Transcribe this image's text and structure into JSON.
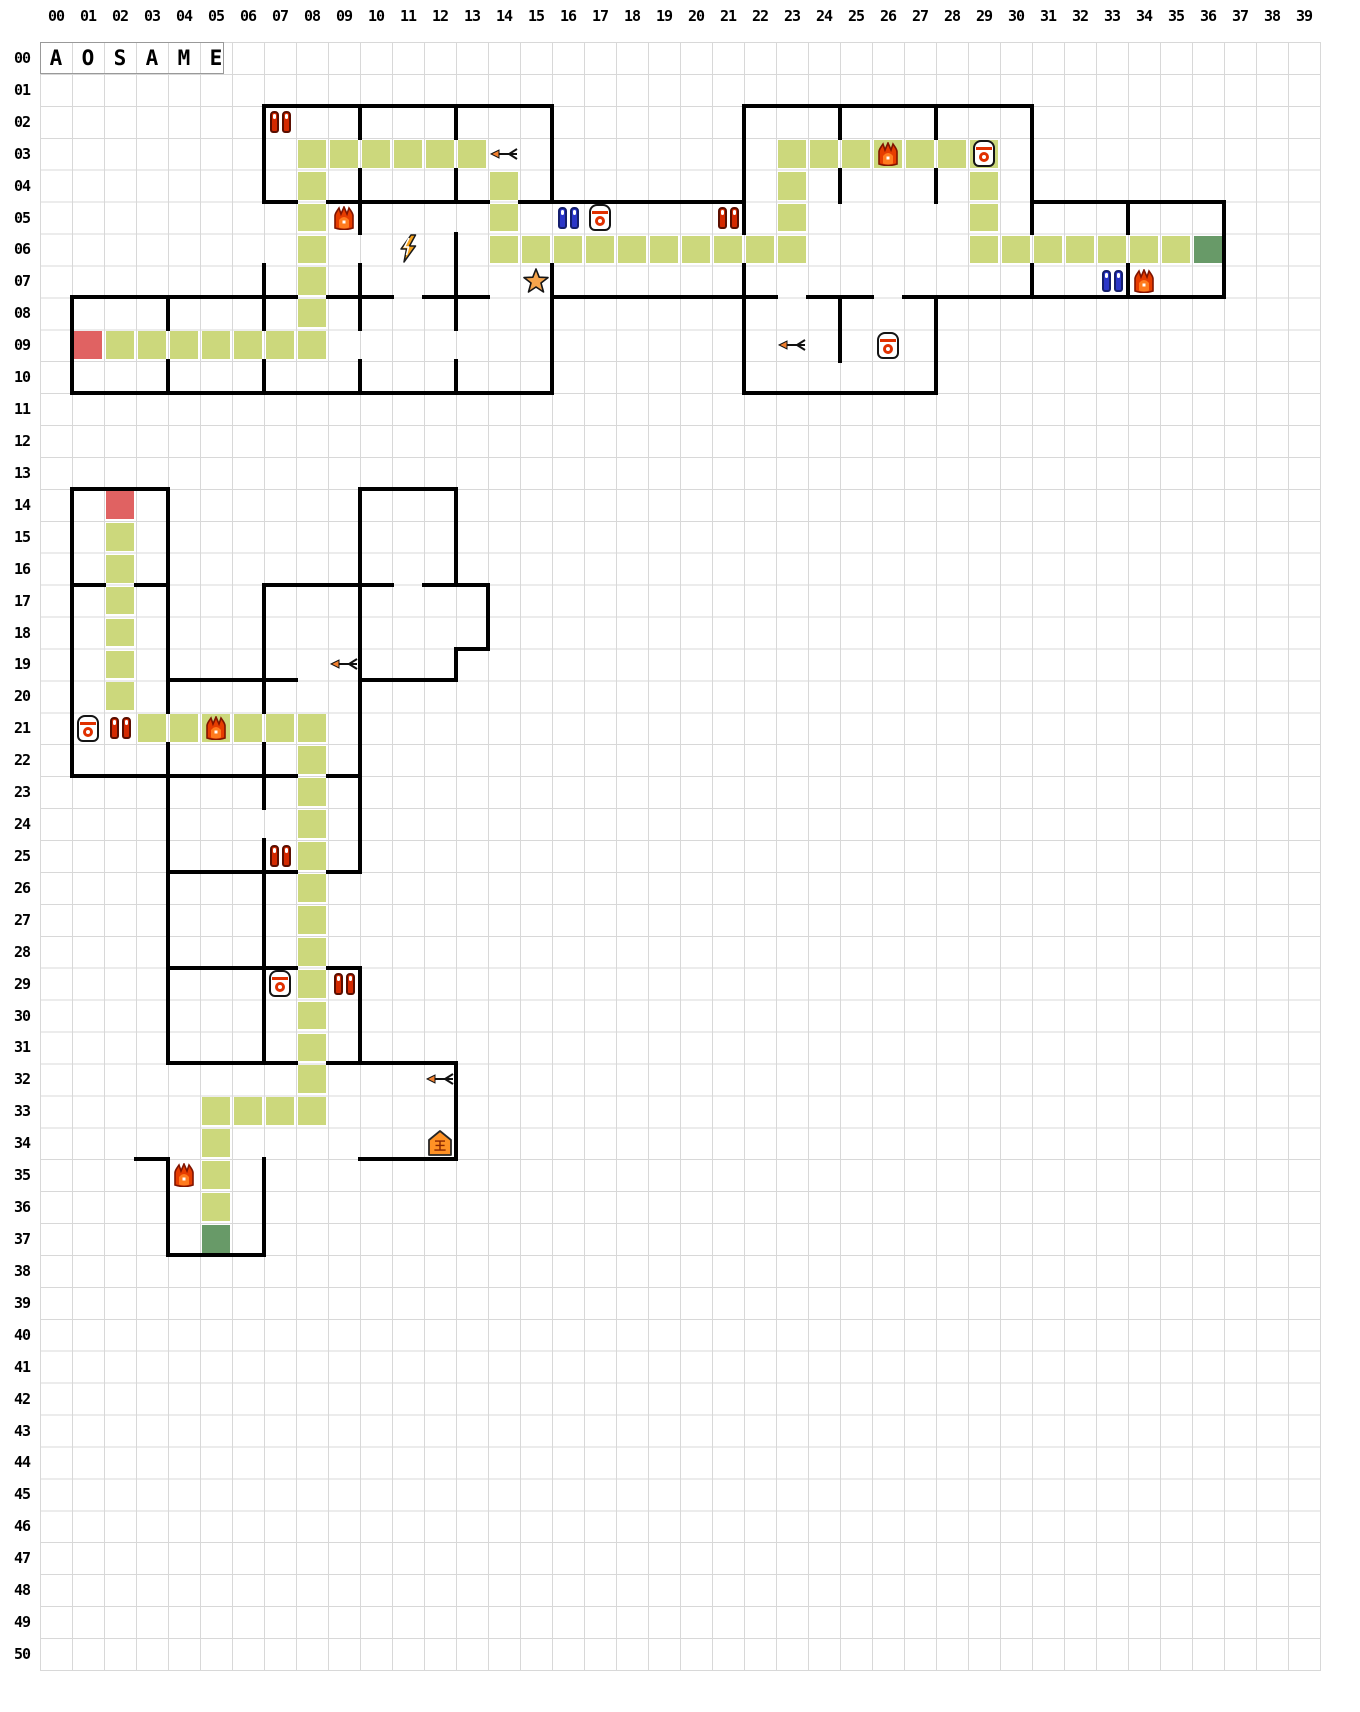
{
  "app": {
    "name_plate": [
      "A",
      "O",
      "S",
      "A",
      "M",
      "E"
    ]
  },
  "grid": {
    "cols": 40,
    "rows": 51,
    "col_labels": [
      "00",
      "01",
      "02",
      "03",
      "04",
      "05",
      "06",
      "07",
      "08",
      "09",
      "10",
      "11",
      "12",
      "13",
      "14",
      "15",
      "16",
      "17",
      "18",
      "19",
      "20",
      "21",
      "22",
      "23",
      "24",
      "25",
      "26",
      "27",
      "28",
      "29",
      "30",
      "31",
      "32",
      "33",
      "34",
      "35",
      "36",
      "37",
      "38",
      "39"
    ],
    "row_labels": [
      "00",
      "01",
      "02",
      "03",
      "04",
      "05",
      "06",
      "07",
      "08",
      "09",
      "10",
      "11",
      "12",
      "13",
      "14",
      "15",
      "16",
      "17",
      "18",
      "19",
      "20",
      "21",
      "22",
      "23",
      "24",
      "25",
      "26",
      "27",
      "28",
      "29",
      "30",
      "31",
      "32",
      "33",
      "34",
      "35",
      "36",
      "37",
      "38",
      "39",
      "40",
      "41",
      "42",
      "43",
      "44",
      "45",
      "46",
      "47",
      "48",
      "49",
      "50"
    ]
  },
  "colors": {
    "background": "#ffffff",
    "grid_line": "#d8d8d8",
    "wall": "#000000",
    "path": "#ccd87c",
    "start": "#e06262",
    "goal": "#689a68",
    "label": "#000000",
    "flame": "#e63d00",
    "flame_inner": "#ff7b1e",
    "capsule_red": "#d42900",
    "capsule_blue": "#2b36c8",
    "bell_accent": "#e03000",
    "lightning": "#f7a21b",
    "star": "#f5a44c",
    "arrow_head": "#f08030",
    "house": "#ff9225"
  },
  "house_glyph": "王",
  "map": {
    "walls_h": [
      [
        2,
        7,
        15
      ],
      [
        2,
        22,
        30
      ],
      [
        5,
        7,
        7
      ],
      [
        5,
        9,
        13
      ],
      [
        5,
        15,
        21
      ],
      [
        5,
        31,
        36
      ],
      [
        8,
        1,
        7
      ],
      [
        8,
        9,
        10
      ],
      [
        8,
        12,
        13
      ],
      [
        8,
        16,
        22
      ],
      [
        8,
        24,
        25
      ],
      [
        8,
        27,
        36
      ],
      [
        11,
        1,
        15
      ],
      [
        11,
        22,
        27
      ],
      [
        14,
        1,
        3
      ],
      [
        14,
        10,
        12
      ],
      [
        17,
        1,
        1
      ],
      [
        17,
        3,
        3
      ],
      [
        17,
        7,
        10
      ],
      [
        17,
        12,
        13
      ],
      [
        19,
        13,
        13
      ],
      [
        20,
        4,
        7
      ],
      [
        20,
        10,
        12
      ],
      [
        23,
        1,
        7
      ],
      [
        23,
        9,
        9
      ],
      [
        26,
        4,
        7
      ],
      [
        26,
        9,
        9
      ],
      [
        29,
        4,
        7
      ],
      [
        29,
        9,
        9
      ],
      [
        32,
        4,
        7
      ],
      [
        32,
        9,
        12
      ],
      [
        35,
        3,
        3
      ],
      [
        35,
        10,
        12
      ],
      [
        38,
        4,
        6
      ]
    ],
    "walls_v": [
      [
        7,
        2,
        4
      ],
      [
        7,
        7,
        8
      ],
      [
        7,
        10,
        10
      ],
      [
        10,
        2,
        2
      ],
      [
        10,
        4,
        5
      ],
      [
        10,
        7,
        8
      ],
      [
        10,
        10,
        10
      ],
      [
        13,
        2,
        2
      ],
      [
        13,
        4,
        4
      ],
      [
        13,
        6,
        8
      ],
      [
        13,
        10,
        10
      ],
      [
        16,
        2,
        4
      ],
      [
        16,
        7,
        10
      ],
      [
        1,
        8,
        10
      ],
      [
        4,
        8,
        8
      ],
      [
        4,
        10,
        10
      ],
      [
        22,
        2,
        5
      ],
      [
        22,
        7,
        10
      ],
      [
        25,
        2,
        2
      ],
      [
        25,
        4,
        4
      ],
      [
        25,
        8,
        9
      ],
      [
        28,
        2,
        2
      ],
      [
        28,
        4,
        4
      ],
      [
        28,
        8,
        10
      ],
      [
        31,
        2,
        5
      ],
      [
        31,
        7,
        7
      ],
      [
        34,
        5,
        5
      ],
      [
        34,
        7,
        7
      ],
      [
        37,
        5,
        7
      ],
      [
        1,
        14,
        22
      ],
      [
        4,
        14,
        20
      ],
      [
        4,
        22,
        31
      ],
      [
        4,
        35,
        37
      ],
      [
        7,
        17,
        20
      ],
      [
        7,
        22,
        23
      ],
      [
        7,
        25,
        31
      ],
      [
        7,
        35,
        37
      ],
      [
        10,
        14,
        25
      ],
      [
        10,
        29,
        31
      ],
      [
        13,
        14,
        16
      ],
      [
        13,
        19,
        19
      ],
      [
        13,
        32,
        34
      ],
      [
        14,
        17,
        18
      ]
    ],
    "path_cells": [
      [
        8,
        3
      ],
      [
        9,
        3
      ],
      [
        10,
        3
      ],
      [
        11,
        3
      ],
      [
        12,
        3
      ],
      [
        13,
        3
      ],
      [
        8,
        4
      ],
      [
        8,
        5
      ],
      [
        8,
        6
      ],
      [
        8,
        7
      ],
      [
        8,
        8
      ],
      [
        8,
        9
      ],
      [
        2,
        9
      ],
      [
        3,
        9
      ],
      [
        4,
        9
      ],
      [
        5,
        9
      ],
      [
        6,
        9
      ],
      [
        7,
        9
      ],
      [
        14,
        4
      ],
      [
        14,
        5
      ],
      [
        14,
        6
      ],
      [
        15,
        6
      ],
      [
        16,
        6
      ],
      [
        17,
        6
      ],
      [
        18,
        6
      ],
      [
        19,
        6
      ],
      [
        20,
        6
      ],
      [
        21,
        6
      ],
      [
        22,
        6
      ],
      [
        23,
        6
      ],
      [
        23,
        3
      ],
      [
        24,
        3
      ],
      [
        25,
        3
      ],
      [
        26,
        3
      ],
      [
        27,
        3
      ],
      [
        28,
        3
      ],
      [
        29,
        3
      ],
      [
        23,
        4
      ],
      [
        23,
        5
      ],
      [
        29,
        4
      ],
      [
        29,
        5
      ],
      [
        29,
        6
      ],
      [
        30,
        6
      ],
      [
        31,
        6
      ],
      [
        32,
        6
      ],
      [
        33,
        6
      ],
      [
        34,
        6
      ],
      [
        35,
        6
      ],
      [
        2,
        15
      ],
      [
        2,
        16
      ],
      [
        2,
        17
      ],
      [
        2,
        18
      ],
      [
        2,
        19
      ],
      [
        2,
        20
      ],
      [
        3,
        21
      ],
      [
        4,
        21
      ],
      [
        5,
        21
      ],
      [
        6,
        21
      ],
      [
        7,
        21
      ],
      [
        8,
        21
      ],
      [
        8,
        22
      ],
      [
        8,
        23
      ],
      [
        8,
        24
      ],
      [
        8,
        25
      ],
      [
        8,
        26
      ],
      [
        8,
        27
      ],
      [
        8,
        28
      ],
      [
        8,
        29
      ],
      [
        8,
        30
      ],
      [
        8,
        31
      ],
      [
        8,
        32
      ],
      [
        5,
        33
      ],
      [
        6,
        33
      ],
      [
        7,
        33
      ],
      [
        8,
        33
      ],
      [
        5,
        34
      ],
      [
        5,
        35
      ],
      [
        5,
        36
      ]
    ],
    "start_cells": [
      [
        1,
        9
      ],
      [
        2,
        14
      ]
    ],
    "goal_cells": [
      [
        36,
        6
      ],
      [
        5,
        37
      ]
    ],
    "icons": [
      [
        "red-pair",
        7,
        2
      ],
      [
        "arrow",
        14,
        3
      ],
      [
        "flame",
        26,
        3
      ],
      [
        "bell",
        29,
        3
      ],
      [
        "flame",
        9,
        5
      ],
      [
        "blue-pair",
        16,
        5
      ],
      [
        "bell",
        17,
        5
      ],
      [
        "red-pair",
        21,
        5
      ],
      [
        "lightning",
        11,
        6
      ],
      [
        "star",
        15,
        7
      ],
      [
        "blue-pair",
        33,
        7
      ],
      [
        "flame",
        34,
        7
      ],
      [
        "arrow",
        23,
        9
      ],
      [
        "bell",
        26,
        9
      ],
      [
        "arrow",
        9,
        19
      ],
      [
        "bell",
        1,
        21
      ],
      [
        "red-pair",
        2,
        21
      ],
      [
        "flame",
        5,
        21
      ],
      [
        "red-pair",
        7,
        25
      ],
      [
        "bell",
        7,
        29
      ],
      [
        "red-pair",
        9,
        29
      ],
      [
        "arrow",
        12,
        32
      ],
      [
        "house",
        12,
        34
      ],
      [
        "flame",
        4,
        35
      ]
    ]
  }
}
